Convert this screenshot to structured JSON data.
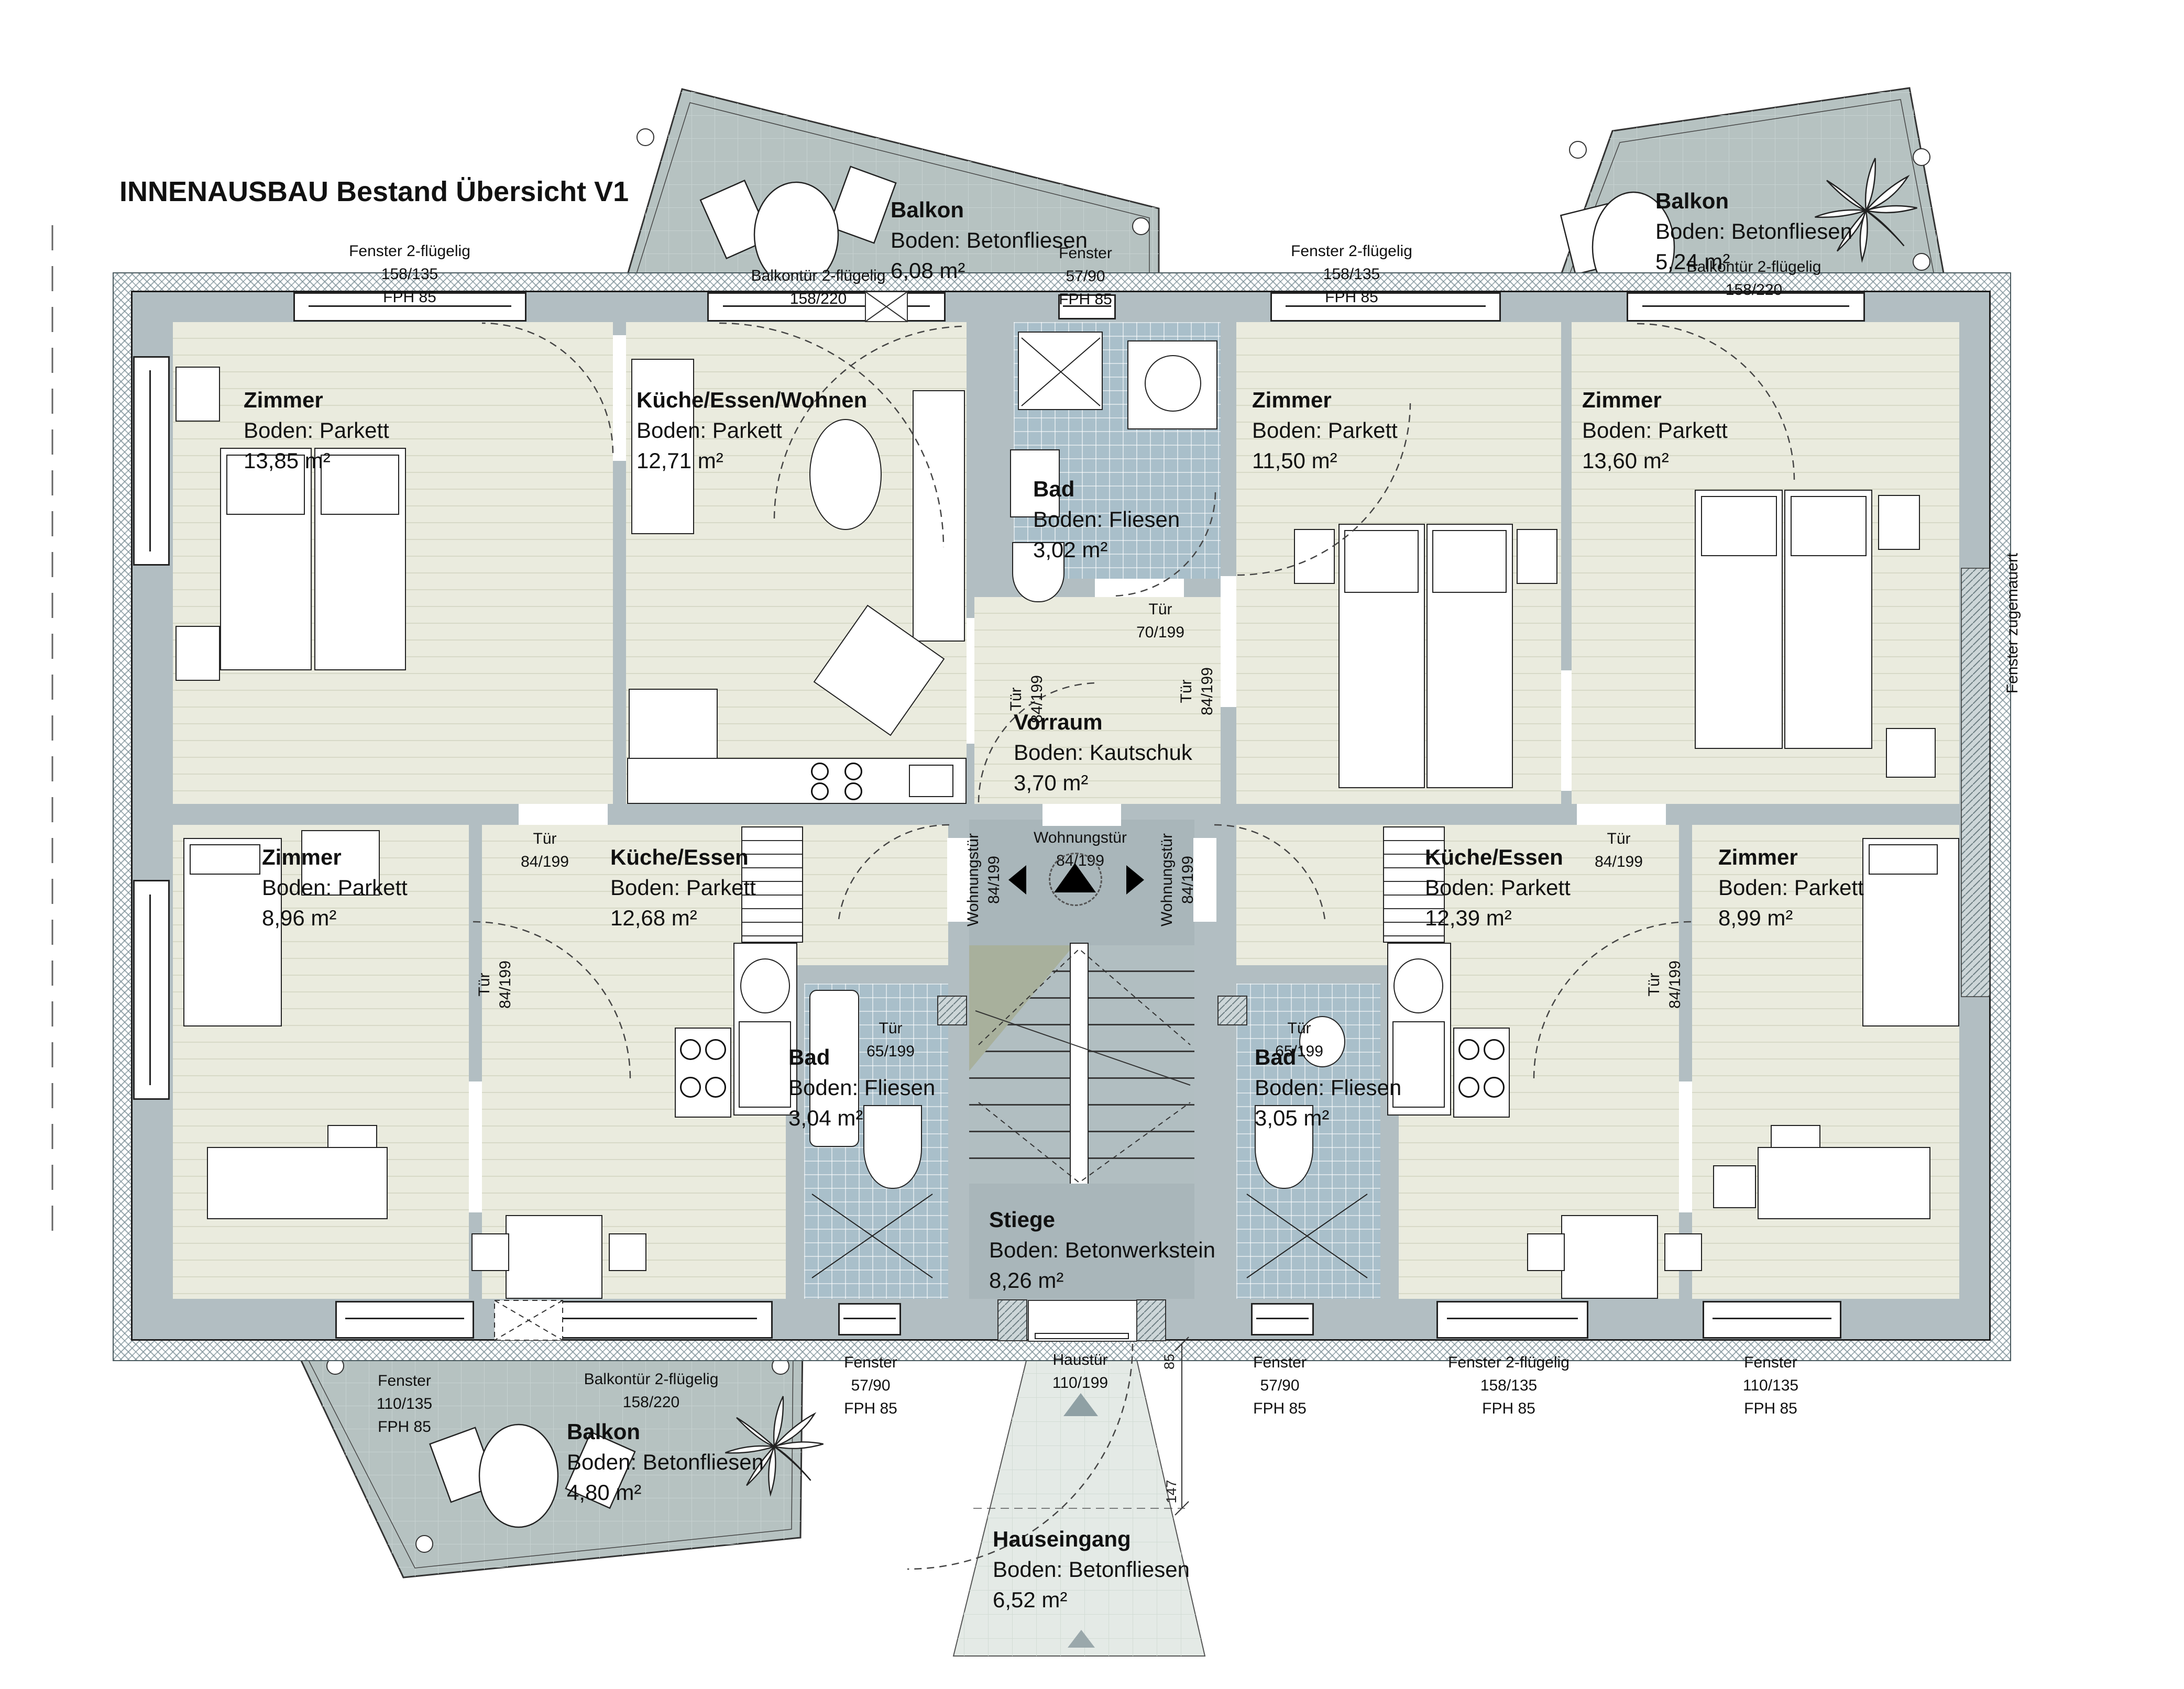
{
  "title": "INNENAUSBAU Bestand Übersicht V1",
  "rooms": {
    "zimmer_tl": {
      "name": "Zimmer",
      "floor": "Boden: Parkett",
      "area": "13,85 m²"
    },
    "kew": {
      "name": "Küche/Essen/Wohnen",
      "floor": "Boden: Parkett",
      "area": "12,71 m²"
    },
    "bad_top": {
      "name": "Bad",
      "floor": "Boden: Fliesen",
      "area": "3,02 m²"
    },
    "vorraum": {
      "name": "Vorraum",
      "floor": "Boden: Kautschuk",
      "area": "3,70 m²"
    },
    "zimmer_1150": {
      "name": "Zimmer",
      "floor": "Boden: Parkett",
      "area": "11,50 m²"
    },
    "zimmer_1360": {
      "name": "Zimmer",
      "floor": "Boden: Parkett",
      "area": "13,60 m²"
    },
    "zimmer_bl": {
      "name": "Zimmer",
      "floor": "Boden: Parkett",
      "area": "8,96 m²"
    },
    "kueche_l": {
      "name": "Küche/Essen",
      "floor": "Boden: Parkett",
      "area": "12,68 m²"
    },
    "bad_bl": {
      "name": "Bad",
      "floor": "Boden: Fliesen",
      "area": "3,04 m²"
    },
    "stiege": {
      "name": "Stiege",
      "floor": "Boden: Betonwerkstein",
      "area": "8,26 m²"
    },
    "bad_br": {
      "name": "Bad",
      "floor": "Boden: Fliesen",
      "area": "3,05 m²"
    },
    "kueche_r": {
      "name": "Küche/Essen",
      "floor": "Boden: Parkett",
      "area": "12,39 m²"
    },
    "zimmer_br": {
      "name": "Zimmer",
      "floor": "Boden: Parkett",
      "area": "8,99 m²"
    },
    "balkon_tl": {
      "name": "Balkon",
      "floor": "Boden: Betonfliesen",
      "area": "6,08 m²"
    },
    "balkon_tr": {
      "name": "Balkon",
      "floor": "Boden: Betonfliesen",
      "area": "5,24 m²"
    },
    "balkon_bl": {
      "name": "Balkon",
      "floor": "Boden: Betonfliesen",
      "area": "4,80 m²"
    },
    "hauseingang": {
      "name": "Hauseingang",
      "floor": "Boden: Betonfliesen",
      "area": "6,52 m²"
    }
  },
  "openings": {
    "fenster_2fl": {
      "l1": "Fenster 2-flügelig",
      "l2": "158/135",
      "l3": "FPH 85"
    },
    "balkontuer": {
      "l1": "Balkontür 2-flügelig",
      "l2": "158/220"
    },
    "fenster_57": {
      "l1": "Fenster",
      "l2": "57/90",
      "l3": "FPH 85"
    },
    "fenster_110": {
      "l1": "Fenster",
      "l2": "110/135",
      "l3": "FPH 85"
    },
    "haustuer": {
      "l1": "Haustür",
      "l2": "110/199"
    },
    "tuer_84": {
      "l1": "Tür",
      "l2": "84/199"
    },
    "tuer_70": {
      "l1": "Tür",
      "l2": "70/199"
    },
    "tuer_65": {
      "l1": "Tür",
      "l2": "65/199"
    },
    "wohnungstuer": {
      "l1": "Wohnungstür",
      "l2": "84/199"
    },
    "fenster_zugemauert": "Fenster zugemauert"
  },
  "dimensions": {
    "entry_depth": "147",
    "entry_offset": "85"
  }
}
